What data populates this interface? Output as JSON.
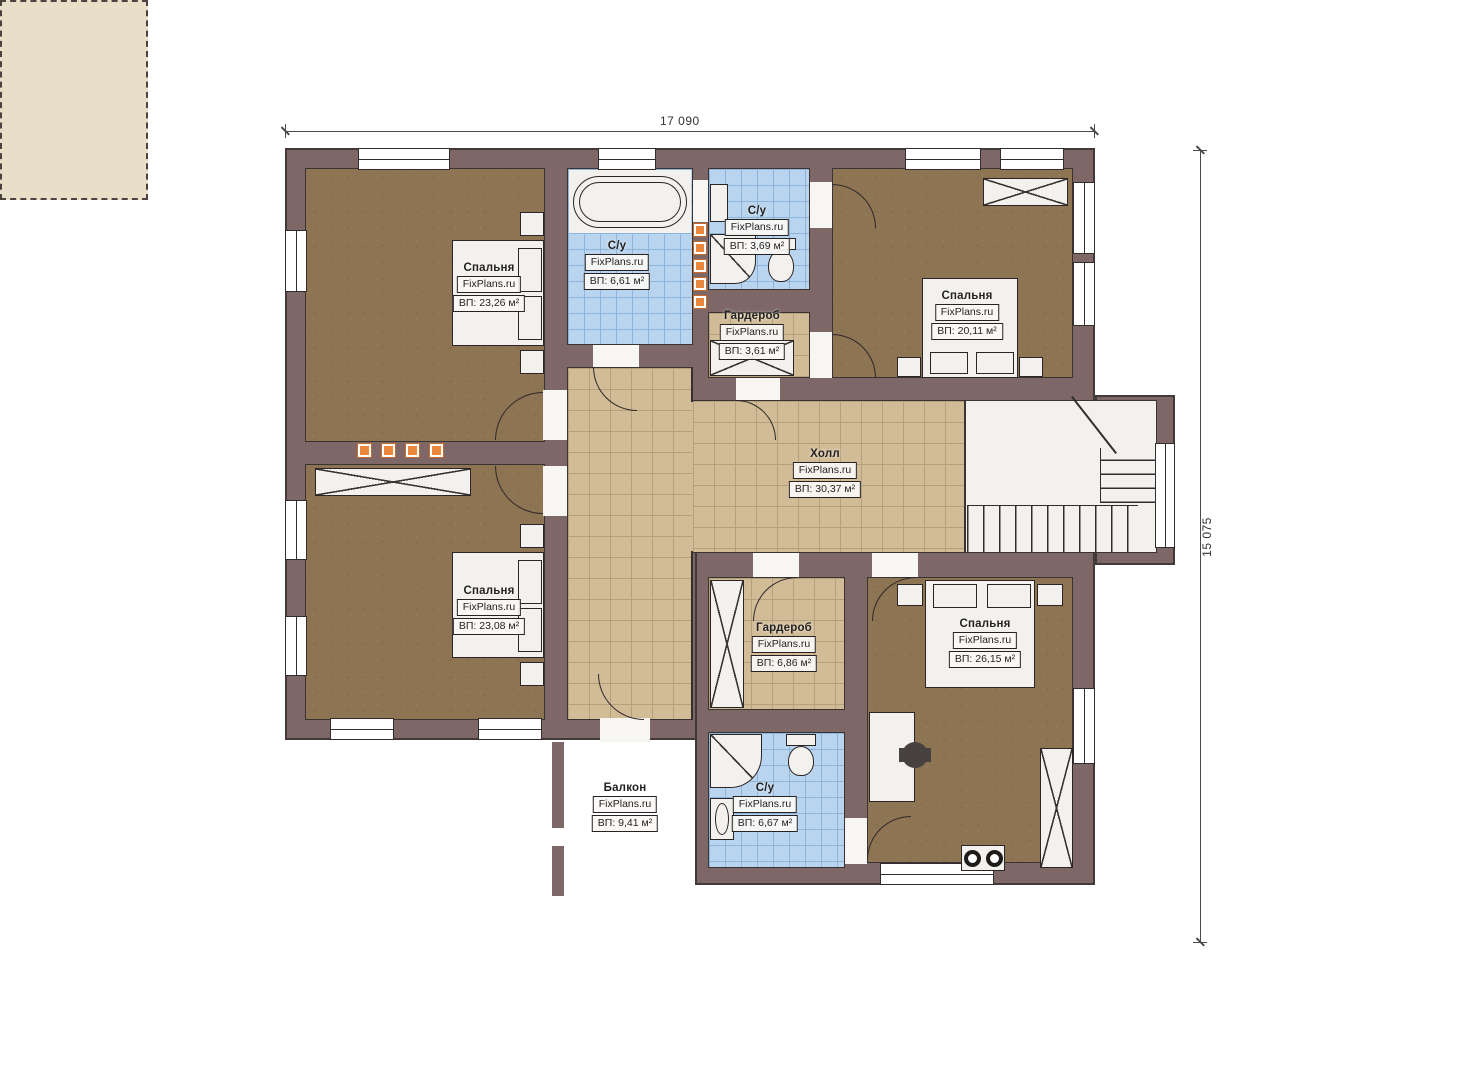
{
  "plan": {
    "watermark": "FixPlans.ru",
    "dimensions": {
      "width_label": "17 090",
      "height_label": "15 075"
    },
    "rooms": [
      {
        "id": "bedroom-top-left",
        "name": "Спальня",
        "area": "ВП: 23,26 м²"
      },
      {
        "id": "bathroom-top",
        "name": "С/у",
        "area": "ВП: 6,61 м²"
      },
      {
        "id": "bathroom-top-small",
        "name": "С/у",
        "area": "ВП: 3,69 м²"
      },
      {
        "id": "wardrobe-top",
        "name": "Гардероб",
        "area": "ВП: 3,61 м²"
      },
      {
        "id": "bedroom-top-right",
        "name": "Спальня",
        "area": "ВП: 20,11 м²"
      },
      {
        "id": "hall",
        "name": "Холл",
        "area": "ВП: 30,37 м²"
      },
      {
        "id": "bedroom-bottom-left",
        "name": "Спальня",
        "area": "ВП: 23,08 м²"
      },
      {
        "id": "wardrobe-bottom",
        "name": "Гардероб",
        "area": "ВП: 6,86 м²"
      },
      {
        "id": "bedroom-bottom-right",
        "name": "Спальня",
        "area": "ВП: 26,15 м²"
      },
      {
        "id": "bathroom-bottom",
        "name": "С/у",
        "area": "ВП: 6,67 м²"
      },
      {
        "id": "balcony",
        "name": "Балкон",
        "area": "ВП: 9,41 м²"
      }
    ],
    "colors": {
      "wall": "#7d6767",
      "carpet": "#8d7453",
      "tile_tan": "#d2bc97",
      "tile_blue": "#b9d4ee",
      "balcony": "#e9dfc9",
      "vent_orange": "#e9873f"
    }
  }
}
